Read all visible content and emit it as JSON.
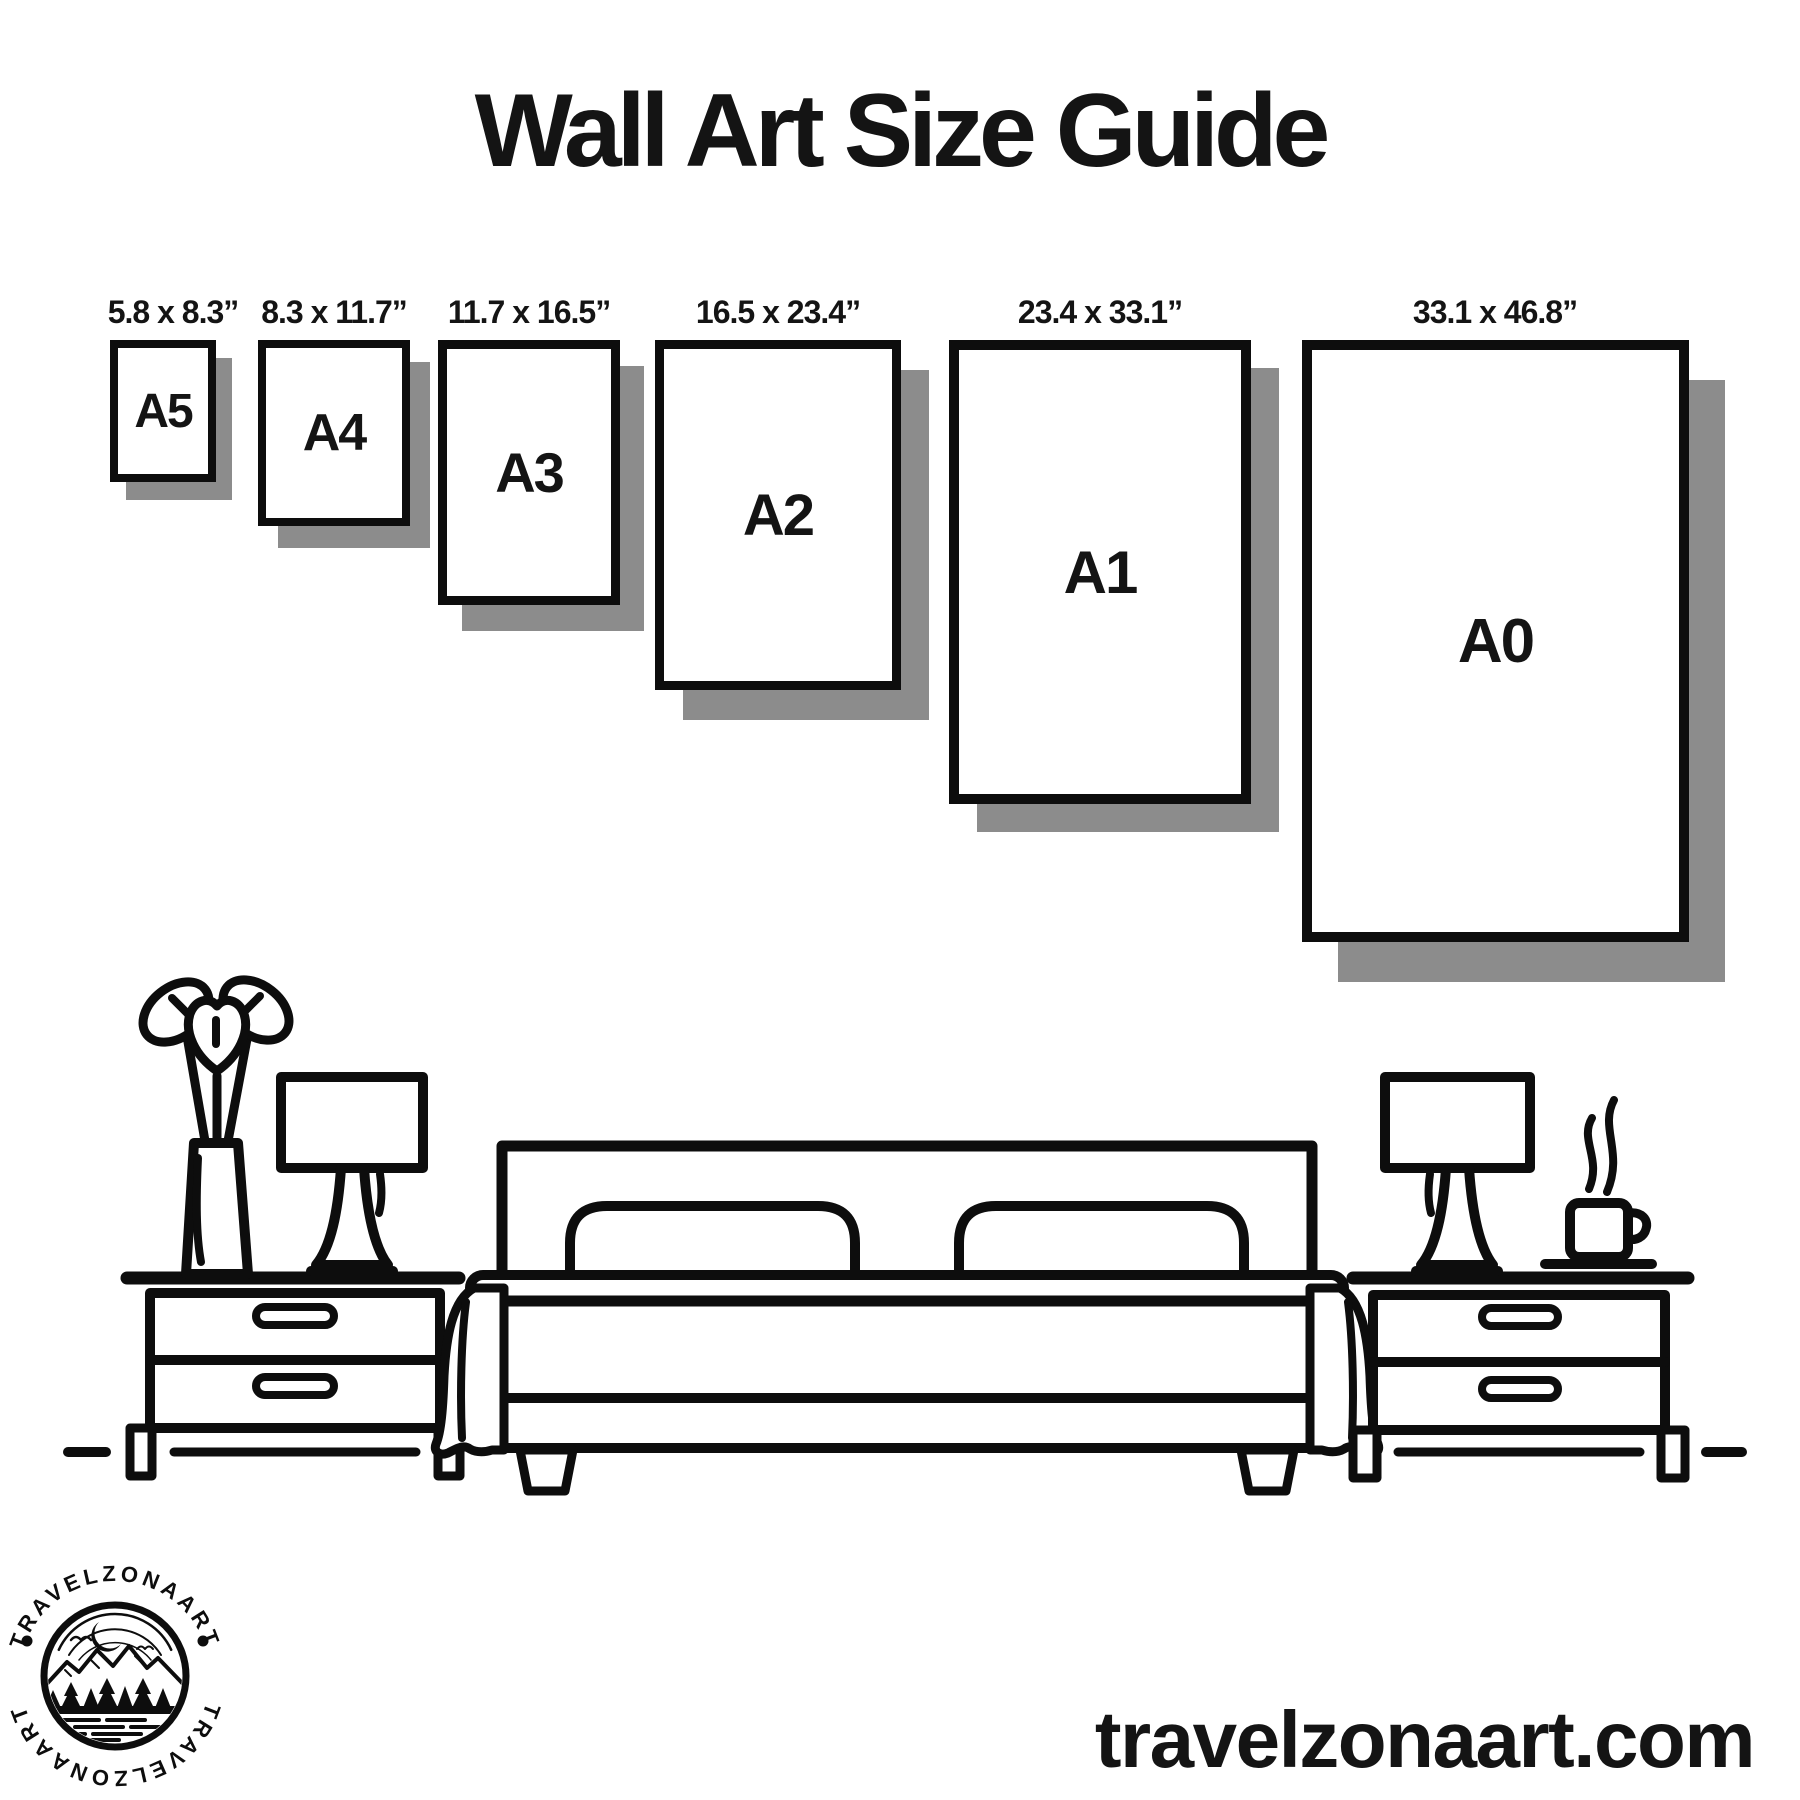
{
  "title": "Wall Art Size Guide",
  "frames": [
    {
      "name": "A5",
      "size_label": "5.8 x 8.3”"
    },
    {
      "name": "A4",
      "size_label": "8.3 x 11.7”"
    },
    {
      "name": "A3",
      "size_label": "11.7 x 16.5”"
    },
    {
      "name": "A2",
      "size_label": "16.5 x 23.4”"
    },
    {
      "name": "A1",
      "size_label": "23.4 x 33.1”"
    },
    {
      "name": "A0",
      "size_label": "33.1 x 46.8”"
    }
  ],
  "website": "travelzonaart.com",
  "logo": {
    "badge_text": "TRAVELZONAART",
    "separator": "•"
  },
  "scene": {
    "icons": [
      "vase-plant-icon",
      "table-lamp-icon",
      "nightstand-icon",
      "double-bed-icon",
      "coffee-mug-icon",
      "steam-icon"
    ]
  },
  "colors": {
    "ink": "#0d0d0d",
    "frame_border": "#0d0d0d",
    "shadow": "#8c8c8c",
    "background": "#ffffff"
  }
}
